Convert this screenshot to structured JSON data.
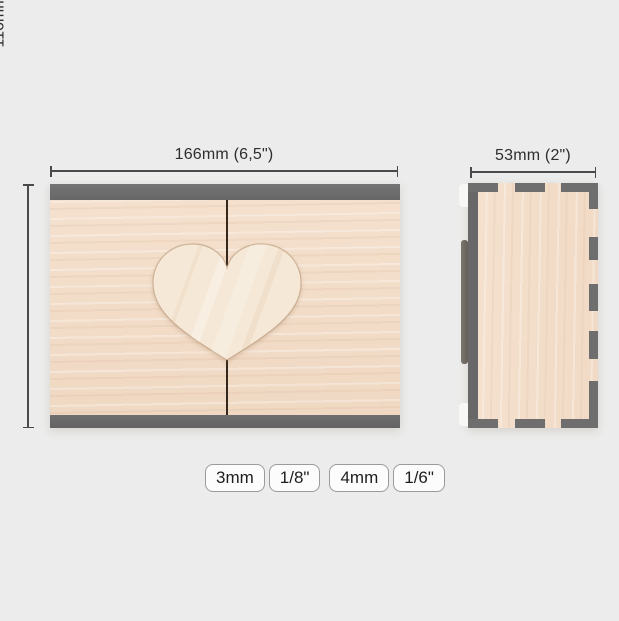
{
  "diagram": {
    "title": "wooden heart box dimension diagram",
    "front_view": {
      "width_label": "166mm (6,5\")",
      "height_label": "116mm (4,5\")"
    },
    "side_view": {
      "depth_label": "53mm (2\")"
    },
    "thickness_options": [
      "3mm",
      "1/8\"",
      "4mm",
      "1/6\""
    ],
    "colors": {
      "background": "#ebeceb",
      "wood": "#f2ddc8",
      "wood_light": "#f6e9d8",
      "edge_gray": "#6e6e6e",
      "seam_dark": "#35281b",
      "dimension_line": "#4a4a4a",
      "badge_border": "#9b9b9b",
      "badge_background": "#fcfcfc",
      "text": "#2a2a2a"
    },
    "icons": {
      "heart": "heart-shape"
    }
  }
}
